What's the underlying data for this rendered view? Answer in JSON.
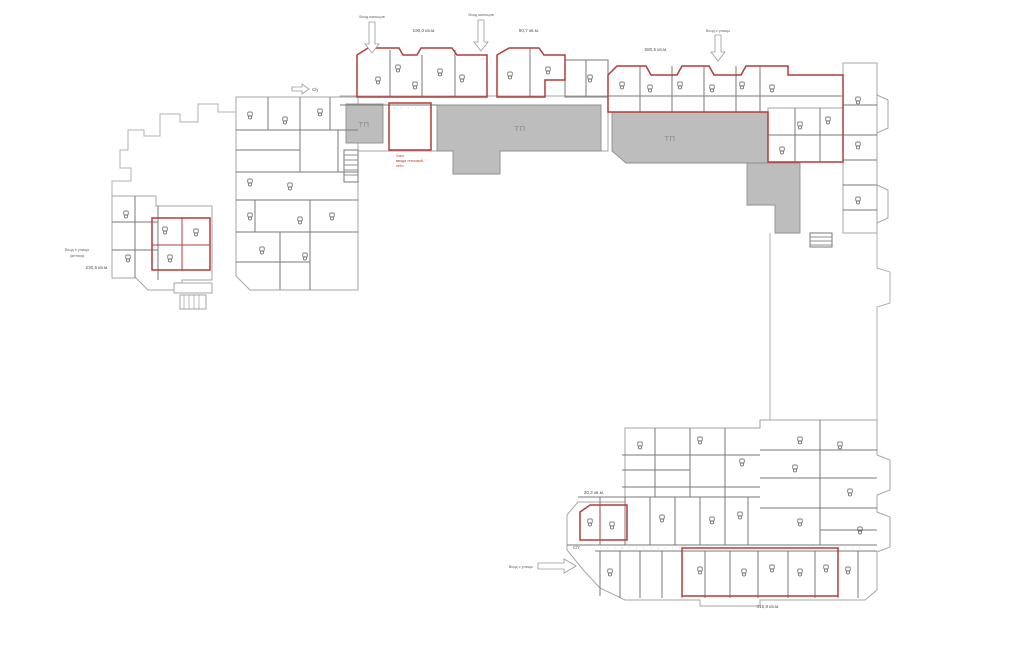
{
  "plan": {
    "tp_label_1": "ТП",
    "tp_label_2": "ТП",
    "tp_label_3": "ТП",
    "area_top_left": "190,0 кв.м.",
    "area_top_mid": "90,7 кв.м.",
    "area_top_right": "580,5 кв.м.",
    "area_left_block": "230,5 кв.м.",
    "area_bottom_small": "30,3 кв.м.",
    "area_bottom_strip": "315,9 кв.м.",
    "entrance_top_1": "Вход жильцов",
    "entrance_top_2": "Вход жильцов",
    "entrance_top_right": "Вход с улицы",
    "entrance_bottom": "Вход с улицы",
    "entrance_left_1": "Вход с улицы",
    "entrance_left_2": "(аптека)",
    "wc_top": "С/у",
    "wc_bottom": "С/У",
    "itp_note_1": "Узел",
    "itp_note_2": "ввода тепловой",
    "itp_note_3": "сети"
  },
  "colors": {
    "commercial_outline": "#b23b3b",
    "tp_fill": "#bdbdbd",
    "wall": "#a6a6a6",
    "partition": "#7a7a7a",
    "note_red": "#c0392b",
    "background": "#ffffff"
  }
}
